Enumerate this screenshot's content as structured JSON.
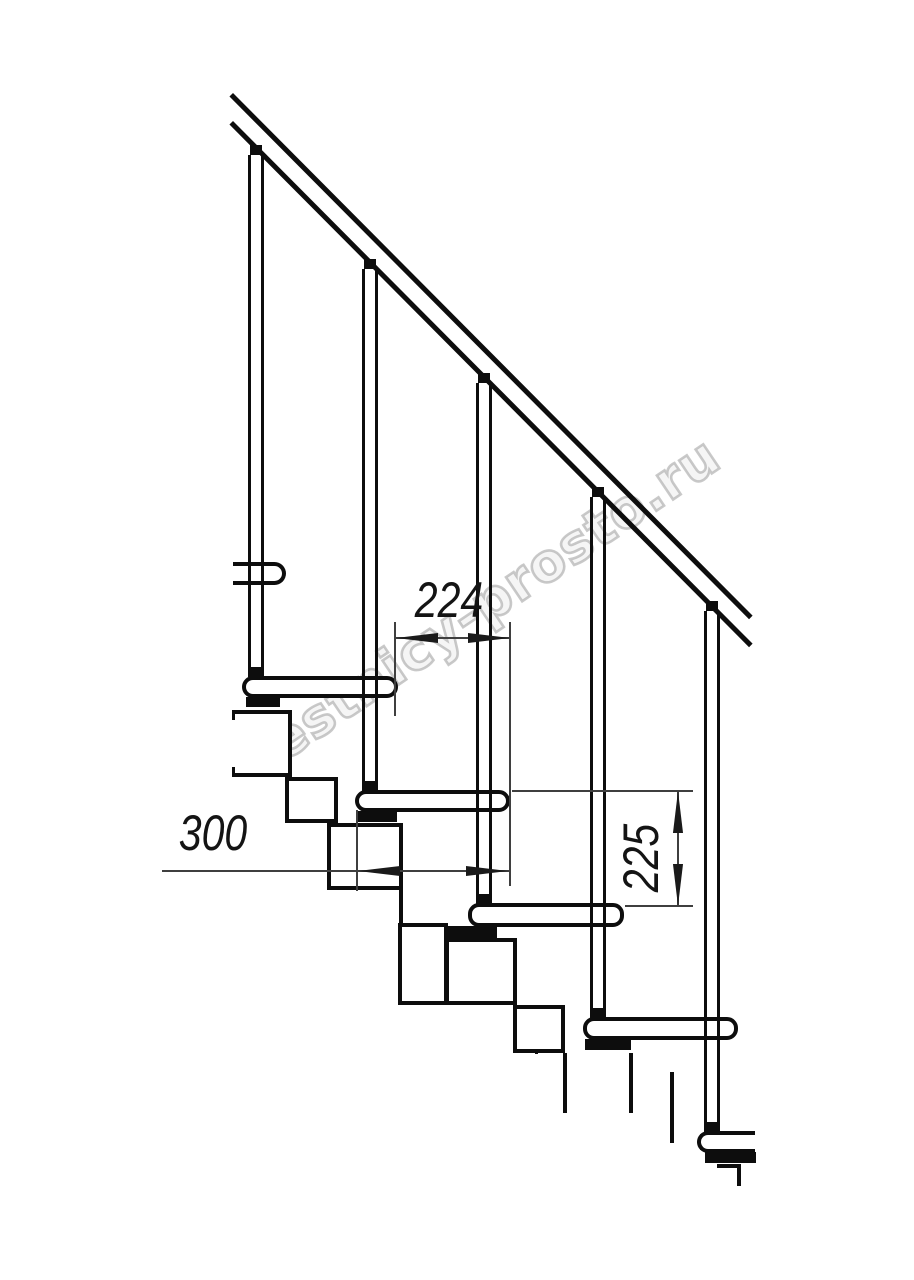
{
  "meta": {
    "title": "Modular staircase side-view technical drawing",
    "type": "technical-line-drawing"
  },
  "watermark": {
    "text": "lestnicy-prosto.ru"
  },
  "dimensions": {
    "going": {
      "value": "224",
      "orientation": "horizontal"
    },
    "tread_depth": {
      "value": "300",
      "orientation": "horizontal"
    },
    "rise": {
      "value": "225",
      "orientation": "vertical"
    }
  },
  "drawing": {
    "balusters_count": 5,
    "tread_levels_count": 6,
    "colors": {
      "line": "#0d0d0d",
      "dim_line": "#3f3f3f",
      "watermark_outline": "#a8a8a8",
      "background": "#ffffff"
    }
  }
}
